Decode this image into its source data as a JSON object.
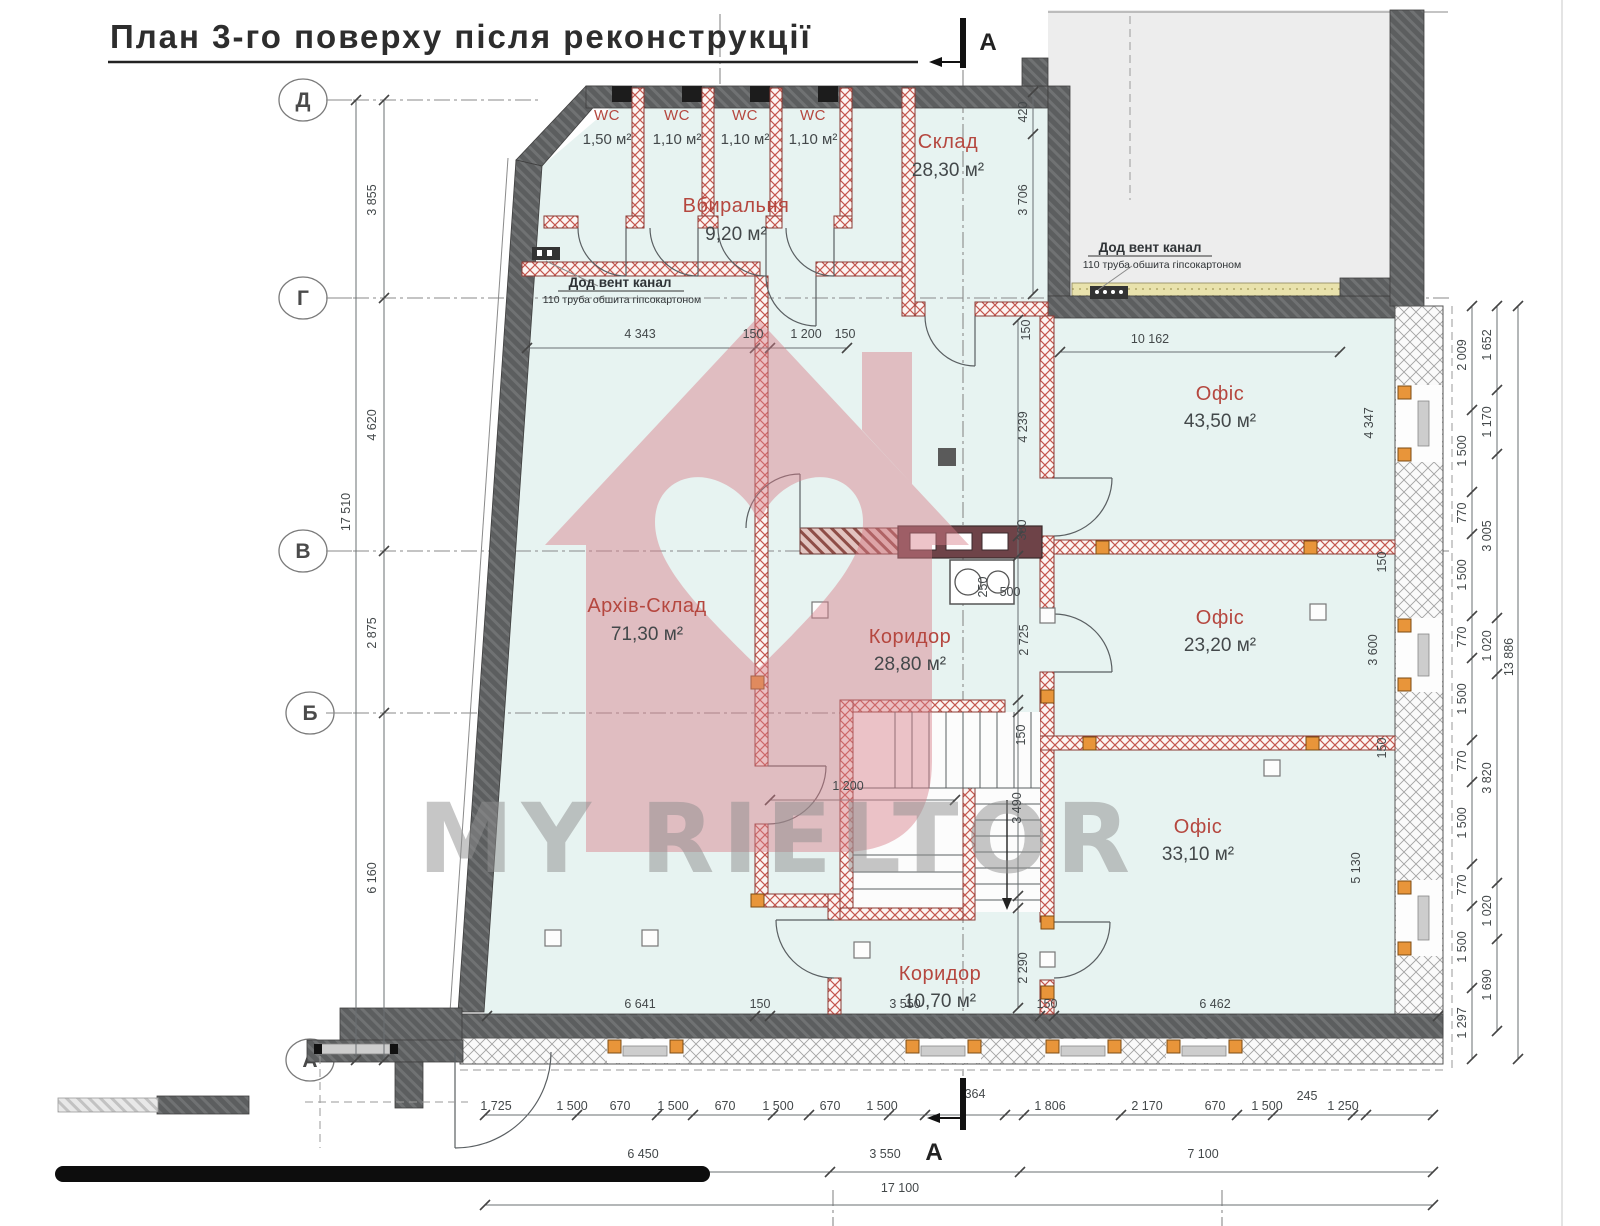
{
  "title": "План 3-го поверху після реконструкції",
  "watermark": {
    "text": "MY RIELTOR"
  },
  "section_markers": {
    "top": "A",
    "bottom": "A"
  },
  "grid_axes": [
    "Д",
    "Г",
    "В",
    "Б",
    "А"
  ],
  "rooms": [
    {
      "name": "WC",
      "area": "1,50 м²"
    },
    {
      "name": "WC",
      "area": "1,10 м²"
    },
    {
      "name": "WC",
      "area": "1,10 м²"
    },
    {
      "name": "WC",
      "area": "1,10 м²"
    },
    {
      "name": "Вбиральня",
      "area": "9,20 м²"
    },
    {
      "name": "Склад",
      "area": "28,30 м²"
    },
    {
      "name": "Офіс",
      "area": "43,50 м²"
    },
    {
      "name": "Архів-Склад",
      "area": "71,30 м²"
    },
    {
      "name": "Коридор",
      "area": "28,80 м²"
    },
    {
      "name": "Офіс",
      "area": "23,20 м²"
    },
    {
      "name": "Офіс",
      "area": "33,10 м²"
    },
    {
      "name": "Коридор",
      "area": "10,70 м²"
    }
  ],
  "notes": [
    {
      "title": "Дод вент канал",
      "subtitle": "110 труба обшита гіпсокартоном"
    },
    {
      "title": "Дод вент канал",
      "subtitle": "110 труба обшита гіпсокартоном"
    }
  ],
  "dimensions": {
    "left_chain": [
      "3 855",
      "4 620",
      "2 875",
      "6 160",
      "17 510"
    ],
    "top_chain": [
      "4 343",
      "150",
      "1 200",
      "150"
    ],
    "top_right": [
      "150",
      "10 162"
    ],
    "middle_column": [
      "420",
      "3 706",
      "4 239",
      "380",
      "2 725",
      "150",
      "2 290"
    ],
    "kitchen": [
      "250",
      "500"
    ],
    "stairs": [
      "1 200",
      "3 490"
    ],
    "right_inner": [
      "2 009",
      "1 500",
      "770",
      "1 500",
      "770",
      "1 500",
      "770",
      "1 500",
      "770",
      "1 500",
      "1 297"
    ],
    "right_mid": [
      "1 652",
      "1 170",
      "3 005",
      "1 020",
      "3 820",
      "1 020",
      "1 690"
    ],
    "right_total": [
      "13 886"
    ],
    "room_heights": [
      "4 347",
      "3 600",
      "5 130"
    ],
    "wall_thickness": [
      "150",
      "150"
    ],
    "above_bottom_wall": [
      "6 641",
      "150",
      "3 550",
      "150",
      "6 462"
    ],
    "bottom_row1": [
      "1 725",
      "1 500",
      "670",
      "1 500",
      "670",
      "1 500",
      "670",
      "1 500",
      "364",
      "1 806",
      "2 170",
      "670",
      "1 500",
      "245",
      "1 250"
    ],
    "bottom_row2": [
      "6 450",
      "3 550",
      "7 100"
    ],
    "bottom_total": [
      "17 100"
    ]
  },
  "colors": {
    "room_fill": "#e7f3f1",
    "adjacent_fill": "#ededed",
    "wall_dark": "#5c5e5f",
    "partition_red": "#c4564e",
    "label_red": "#b5473f",
    "dim_text": "#43484a",
    "watermark_pink": "#d77f8a",
    "watermark_gray": "#8f8f8f",
    "window_orange": "#e8953a",
    "vent_yellow": "#e9e2ac"
  }
}
